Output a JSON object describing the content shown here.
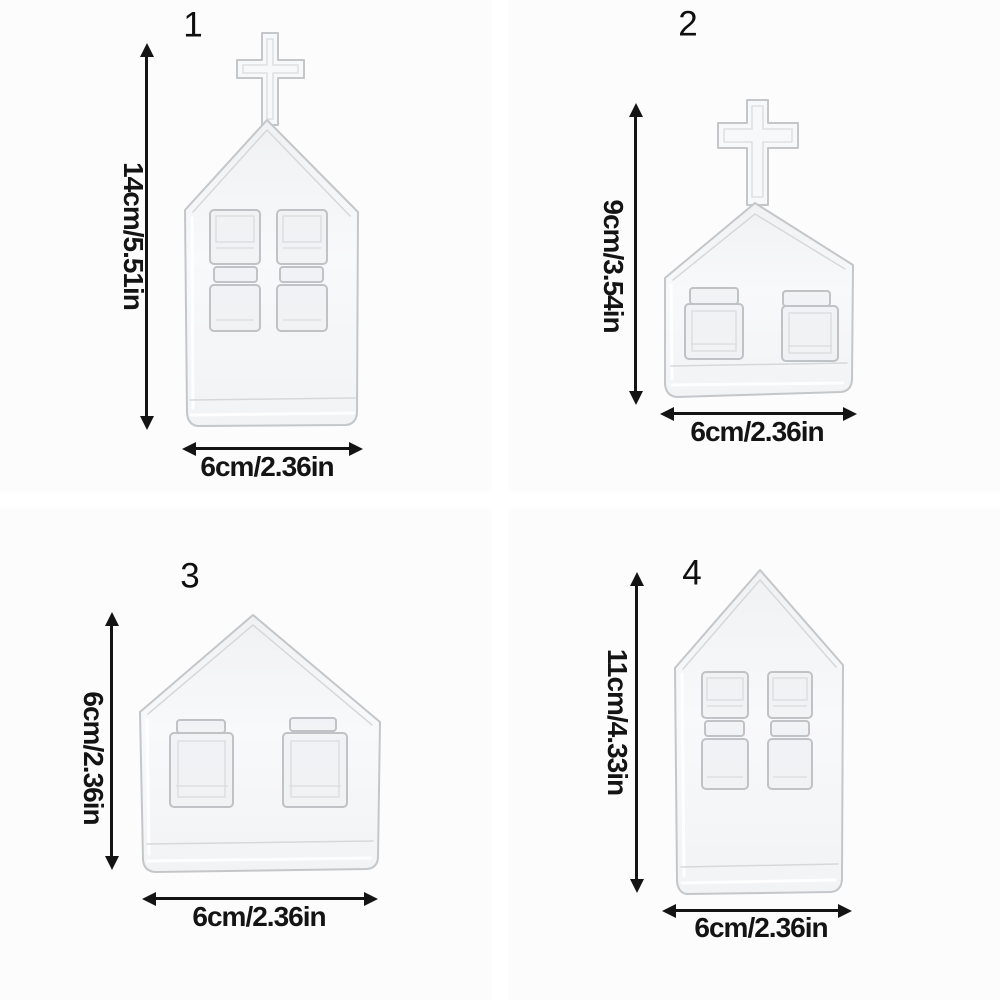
{
  "figure": {
    "title": "glass house vase size chart",
    "items": [
      {
        "number": "1",
        "icon": "church-vase-with-cross-icon",
        "height_label": "14cm/5.51in",
        "width_label": "6cm/2.36in"
      },
      {
        "number": "2",
        "icon": "church-vase-with-cross-icon",
        "height_label": "9cm/3.54in",
        "width_label": "6cm/2.36in"
      },
      {
        "number": "3",
        "icon": "house-vase-icon",
        "height_label": "6cm/2.36in",
        "width_label": "6cm/2.36in"
      },
      {
        "number": "4",
        "icon": "house-vase-icon",
        "height_label": "11cm/4.33in",
        "width_label": "6cm/2.36in"
      }
    ],
    "colors": {
      "background": "#ffffff",
      "quadrant_background": "#fcfcfd",
      "text": "#141414",
      "arrow": "#141414",
      "glass_stroke": "#c4c7ca",
      "glass_fill": "#f4f5f6"
    }
  }
}
